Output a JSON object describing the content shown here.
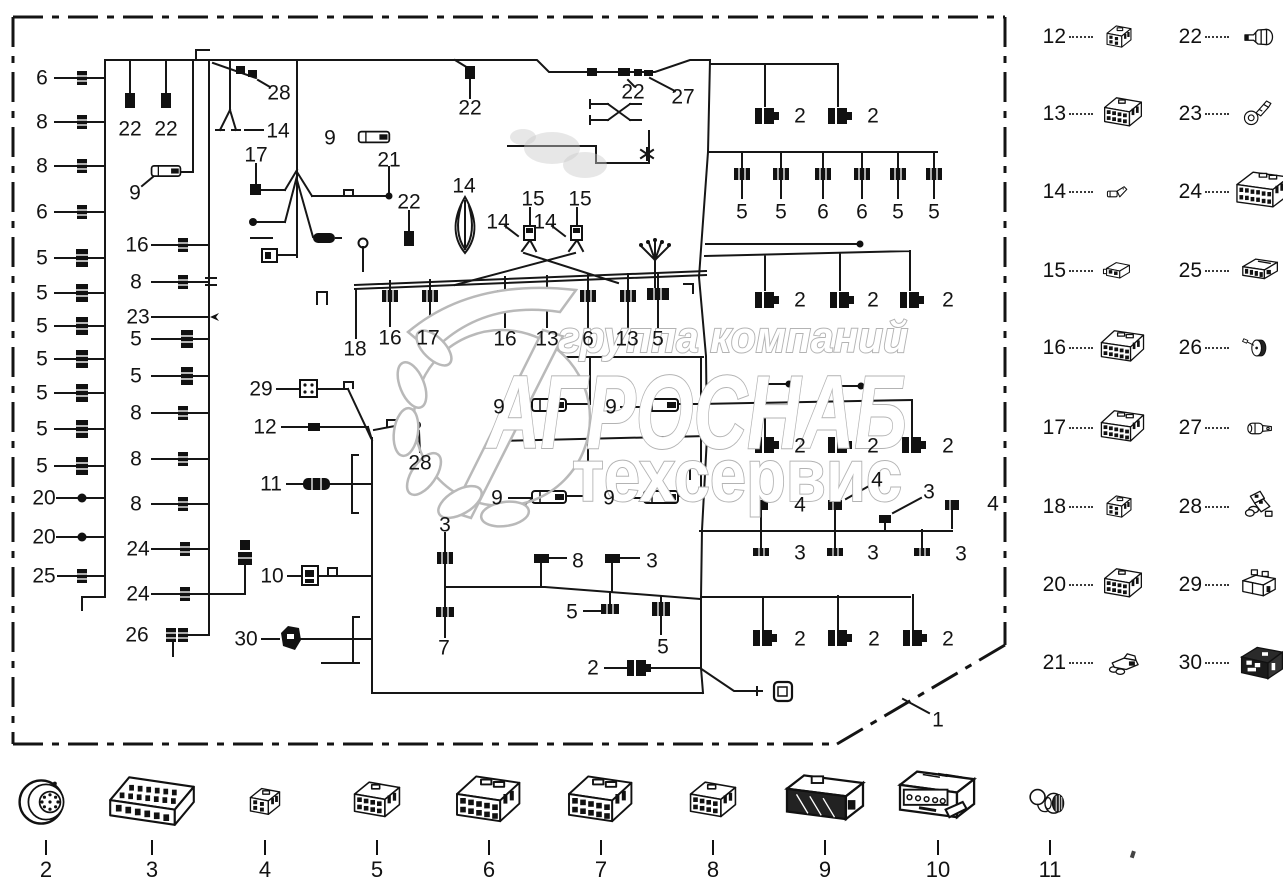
{
  "watermark": {
    "line1": "группа компаний",
    "line2": "АГРОСНАБ",
    "line3": "техсервис",
    "outline_color": "#b3b3b3"
  },
  "diagram": {
    "callouts": [
      {
        "t": "6",
        "x": 42,
        "y": 78
      },
      {
        "t": "8",
        "x": 42,
        "y": 122
      },
      {
        "t": "8",
        "x": 42,
        "y": 166
      },
      {
        "t": "6",
        "x": 42,
        "y": 212
      },
      {
        "t": "5",
        "x": 42,
        "y": 258
      },
      {
        "t": "5",
        "x": 42,
        "y": 293
      },
      {
        "t": "5",
        "x": 42,
        "y": 326
      },
      {
        "t": "5",
        "x": 42,
        "y": 359
      },
      {
        "t": "5",
        "x": 42,
        "y": 393
      },
      {
        "t": "5",
        "x": 42,
        "y": 429
      },
      {
        "t": "5",
        "x": 42,
        "y": 466
      },
      {
        "t": "20",
        "x": 44,
        "y": 498
      },
      {
        "t": "20",
        "x": 44,
        "y": 537
      },
      {
        "t": "25",
        "x": 44,
        "y": 576
      },
      {
        "t": "22",
        "x": 130,
        "y": 129
      },
      {
        "t": "22",
        "x": 166,
        "y": 129
      },
      {
        "t": "9",
        "x": 135,
        "y": 193
      },
      {
        "t": "16",
        "x": 137,
        "y": 245
      },
      {
        "t": "8",
        "x": 136,
        "y": 282
      },
      {
        "t": "23",
        "x": 138,
        "y": 317
      },
      {
        "t": "5",
        "x": 136,
        "y": 339
      },
      {
        "t": "5",
        "x": 136,
        "y": 376
      },
      {
        "t": "8",
        "x": 136,
        "y": 413
      },
      {
        "t": "8",
        "x": 136,
        "y": 459
      },
      {
        "t": "8",
        "x": 136,
        "y": 504
      },
      {
        "t": "24",
        "x": 138,
        "y": 549
      },
      {
        "t": "24",
        "x": 138,
        "y": 594
      },
      {
        "t": "26",
        "x": 137,
        "y": 635
      },
      {
        "t": "28",
        "x": 279,
        "y": 93
      },
      {
        "t": "14",
        "x": 278,
        "y": 131
      },
      {
        "t": "17",
        "x": 256,
        "y": 155
      },
      {
        "t": "9",
        "x": 330,
        "y": 138
      },
      {
        "t": "21",
        "x": 389,
        "y": 160
      },
      {
        "t": "22",
        "x": 409,
        "y": 202
      },
      {
        "t": "22",
        "x": 470,
        "y": 108
      },
      {
        "t": "14",
        "x": 464,
        "y": 186
      },
      {
        "t": "15",
        "x": 533,
        "y": 199
      },
      {
        "t": "15",
        "x": 580,
        "y": 199
      },
      {
        "t": "14",
        "x": 498,
        "y": 222
      },
      {
        "t": "14",
        "x": 545,
        "y": 222
      },
      {
        "t": "22",
        "x": 633,
        "y": 92
      },
      {
        "t": "27",
        "x": 683,
        "y": 97
      },
      {
        "t": "18",
        "x": 355,
        "y": 349
      },
      {
        "t": "16",
        "x": 390,
        "y": 338
      },
      {
        "t": "17",
        "x": 428,
        "y": 338
      },
      {
        "t": "16",
        "x": 505,
        "y": 339
      },
      {
        "t": "13",
        "x": 547,
        "y": 339
      },
      {
        "t": "6",
        "x": 588,
        "y": 339
      },
      {
        "t": "13",
        "x": 627,
        "y": 339
      },
      {
        "t": "5",
        "x": 658,
        "y": 339
      },
      {
        "t": "29",
        "x": 261,
        "y": 389
      },
      {
        "t": "12",
        "x": 265,
        "y": 427
      },
      {
        "t": "28",
        "x": 420,
        "y": 463
      },
      {
        "t": "11",
        "x": 271,
        "y": 484
      },
      {
        "t": "10",
        "x": 272,
        "y": 576
      },
      {
        "t": "30",
        "x": 246,
        "y": 639
      },
      {
        "t": "9",
        "x": 499,
        "y": 407
      },
      {
        "t": "9",
        "x": 611,
        "y": 407
      },
      {
        "t": "9",
        "x": 497,
        "y": 498
      },
      {
        "t": "9",
        "x": 609,
        "y": 498
      },
      {
        "t": "3",
        "x": 445,
        "y": 525
      },
      {
        "t": "8",
        "x": 578,
        "y": 561
      },
      {
        "t": "3",
        "x": 652,
        "y": 561
      },
      {
        "t": "5",
        "x": 572,
        "y": 612
      },
      {
        "t": "7",
        "x": 444,
        "y": 648
      },
      {
        "t": "5",
        "x": 663,
        "y": 647
      },
      {
        "t": "2",
        "x": 593,
        "y": 668
      },
      {
        "t": "2",
        "x": 800,
        "y": 116
      },
      {
        "t": "2",
        "x": 873,
        "y": 116
      },
      {
        "t": "5",
        "x": 742,
        "y": 212
      },
      {
        "t": "5",
        "x": 781,
        "y": 212
      },
      {
        "t": "6",
        "x": 823,
        "y": 212
      },
      {
        "t": "6",
        "x": 862,
        "y": 212
      },
      {
        "t": "5",
        "x": 898,
        "y": 212
      },
      {
        "t": "5",
        "x": 934,
        "y": 212
      },
      {
        "t": "2",
        "x": 800,
        "y": 300
      },
      {
        "t": "2",
        "x": 873,
        "y": 300
      },
      {
        "t": "2",
        "x": 948,
        "y": 300
      },
      {
        "t": "2",
        "x": 800,
        "y": 446
      },
      {
        "t": "2",
        "x": 873,
        "y": 446
      },
      {
        "t": "2",
        "x": 948,
        "y": 446
      },
      {
        "t": "4",
        "x": 800,
        "y": 505
      },
      {
        "t": "4",
        "x": 877,
        "y": 480
      },
      {
        "t": "3",
        "x": 929,
        "y": 492
      },
      {
        "t": "4",
        "x": 993,
        "y": 504
      },
      {
        "t": "3",
        "x": 800,
        "y": 553
      },
      {
        "t": "3",
        "x": 873,
        "y": 553
      },
      {
        "t": "3",
        "x": 961,
        "y": 554
      },
      {
        "t": "2",
        "x": 800,
        "y": 639
      },
      {
        "t": "2",
        "x": 874,
        "y": 639
      },
      {
        "t": "2",
        "x": 948,
        "y": 639
      },
      {
        "t": "1",
        "x": 938,
        "y": 720
      }
    ]
  },
  "legend_right": {
    "items": [
      {
        "num": "12",
        "icon": "block-sm",
        "x": 1032,
        "y": 37
      },
      {
        "num": "22",
        "icon": "boot-22",
        "x": 1168,
        "y": 37
      },
      {
        "num": "13",
        "icon": "block-md",
        "x": 1032,
        "y": 114
      },
      {
        "num": "23",
        "icon": "ring-23",
        "x": 1168,
        "y": 114
      },
      {
        "num": "14",
        "icon": "pin-14",
        "x": 1032,
        "y": 192
      },
      {
        "num": "24",
        "icon": "block-xl",
        "x": 1168,
        "y": 192
      },
      {
        "num": "15",
        "icon": "flat-15",
        "x": 1032,
        "y": 271
      },
      {
        "num": "25",
        "icon": "flat-25",
        "x": 1168,
        "y": 271
      },
      {
        "num": "16",
        "icon": "block-lg",
        "x": 1032,
        "y": 348
      },
      {
        "num": "26",
        "icon": "grommet-26",
        "x": 1168,
        "y": 348
      },
      {
        "num": "17",
        "icon": "block-lg",
        "x": 1032,
        "y": 428
      },
      {
        "num": "27",
        "icon": "spade-27",
        "x": 1168,
        "y": 428
      },
      {
        "num": "18",
        "icon": "block-sm",
        "x": 1032,
        "y": 507
      },
      {
        "num": "28",
        "icon": "boot-28",
        "x": 1168,
        "y": 507
      },
      {
        "num": "20",
        "icon": "block-md",
        "x": 1032,
        "y": 585
      },
      {
        "num": "29",
        "icon": "relay-29",
        "x": 1168,
        "y": 585
      },
      {
        "num": "21",
        "icon": "boot-21",
        "x": 1032,
        "y": 663
      },
      {
        "num": "30",
        "icon": "dark-30",
        "x": 1168,
        "y": 663
      }
    ]
  },
  "legend_bottom": {
    "items": [
      {
        "num": "2",
        "icon": "round-2",
        "x": 46,
        "y": 762
      },
      {
        "num": "3",
        "icon": "block-long",
        "x": 152,
        "y": 762
      },
      {
        "num": "4",
        "icon": "block-sm",
        "x": 265,
        "y": 762
      },
      {
        "num": "5",
        "icon": "block-md",
        "x": 377,
        "y": 762
      },
      {
        "num": "6",
        "icon": "block-lg",
        "x": 489,
        "y": 762
      },
      {
        "num": "7",
        "icon": "block-lg",
        "x": 601,
        "y": 762
      },
      {
        "num": "8",
        "icon": "block-md",
        "x": 713,
        "y": 762
      },
      {
        "num": "9",
        "icon": "lamp-9",
        "x": 825,
        "y": 762
      },
      {
        "num": "10",
        "icon": "plug-10",
        "x": 938,
        "y": 762
      },
      {
        "num": "11",
        "icon": "loop-11",
        "x": 1050,
        "y": 762
      }
    ]
  }
}
